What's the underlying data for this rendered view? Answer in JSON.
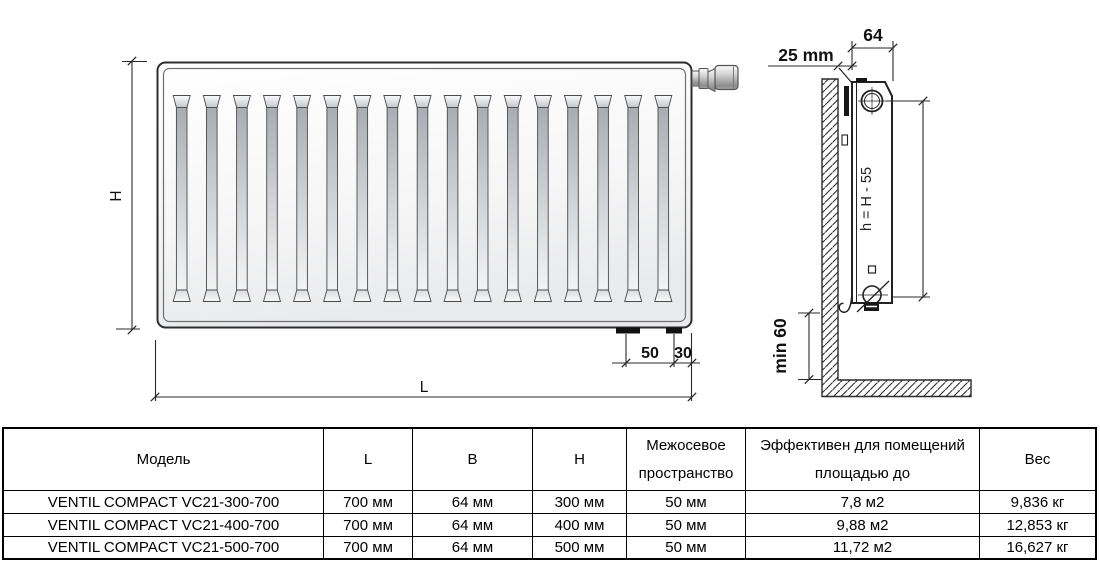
{
  "drawing": {
    "front_view": {
      "height_dim": "H",
      "length_dim": "L",
      "connection_offset_dim": "50",
      "edge_offset_dim": "30"
    },
    "side_view": {
      "wall_gap_dim": "25 mm",
      "depth_dim": "64",
      "axis_height_dim": "h = H - 55",
      "floor_clearance_dim": "min 60"
    }
  },
  "table": {
    "headers": {
      "model": "Модель",
      "length": "L",
      "depth": "B",
      "height": "H",
      "spacing_line1": "Межосевое",
      "spacing_line2": "пространство",
      "area_line1": "Эффективен для помещений",
      "area_line2": "площадью до",
      "weight": "Вес"
    },
    "rows": [
      {
        "model": "VENTIL COMPACT VC21-300-700",
        "length": "700 мм",
        "depth": "64 мм",
        "height": "300 мм",
        "spacing": "50 мм",
        "area": "7,8 м2",
        "weight": "9,836 кг"
      },
      {
        "model": "VENTIL COMPACT VC21-400-700",
        "length": "700 мм",
        "depth": "64 мм",
        "height": "400 мм",
        "spacing": "50 мм",
        "area": "9,88 м2",
        "weight": "12,853 кг"
      },
      {
        "model": "VENTIL COMPACT VC21-500-700",
        "length": "700 мм",
        "depth": "64 мм",
        "height": "500 мм",
        "spacing": "50 мм",
        "area": "11,72 м2",
        "weight": "16,627 кг"
      }
    ]
  },
  "colors": {
    "line": "#2a2a2a",
    "text": "#000000",
    "background": "#ffffff"
  }
}
